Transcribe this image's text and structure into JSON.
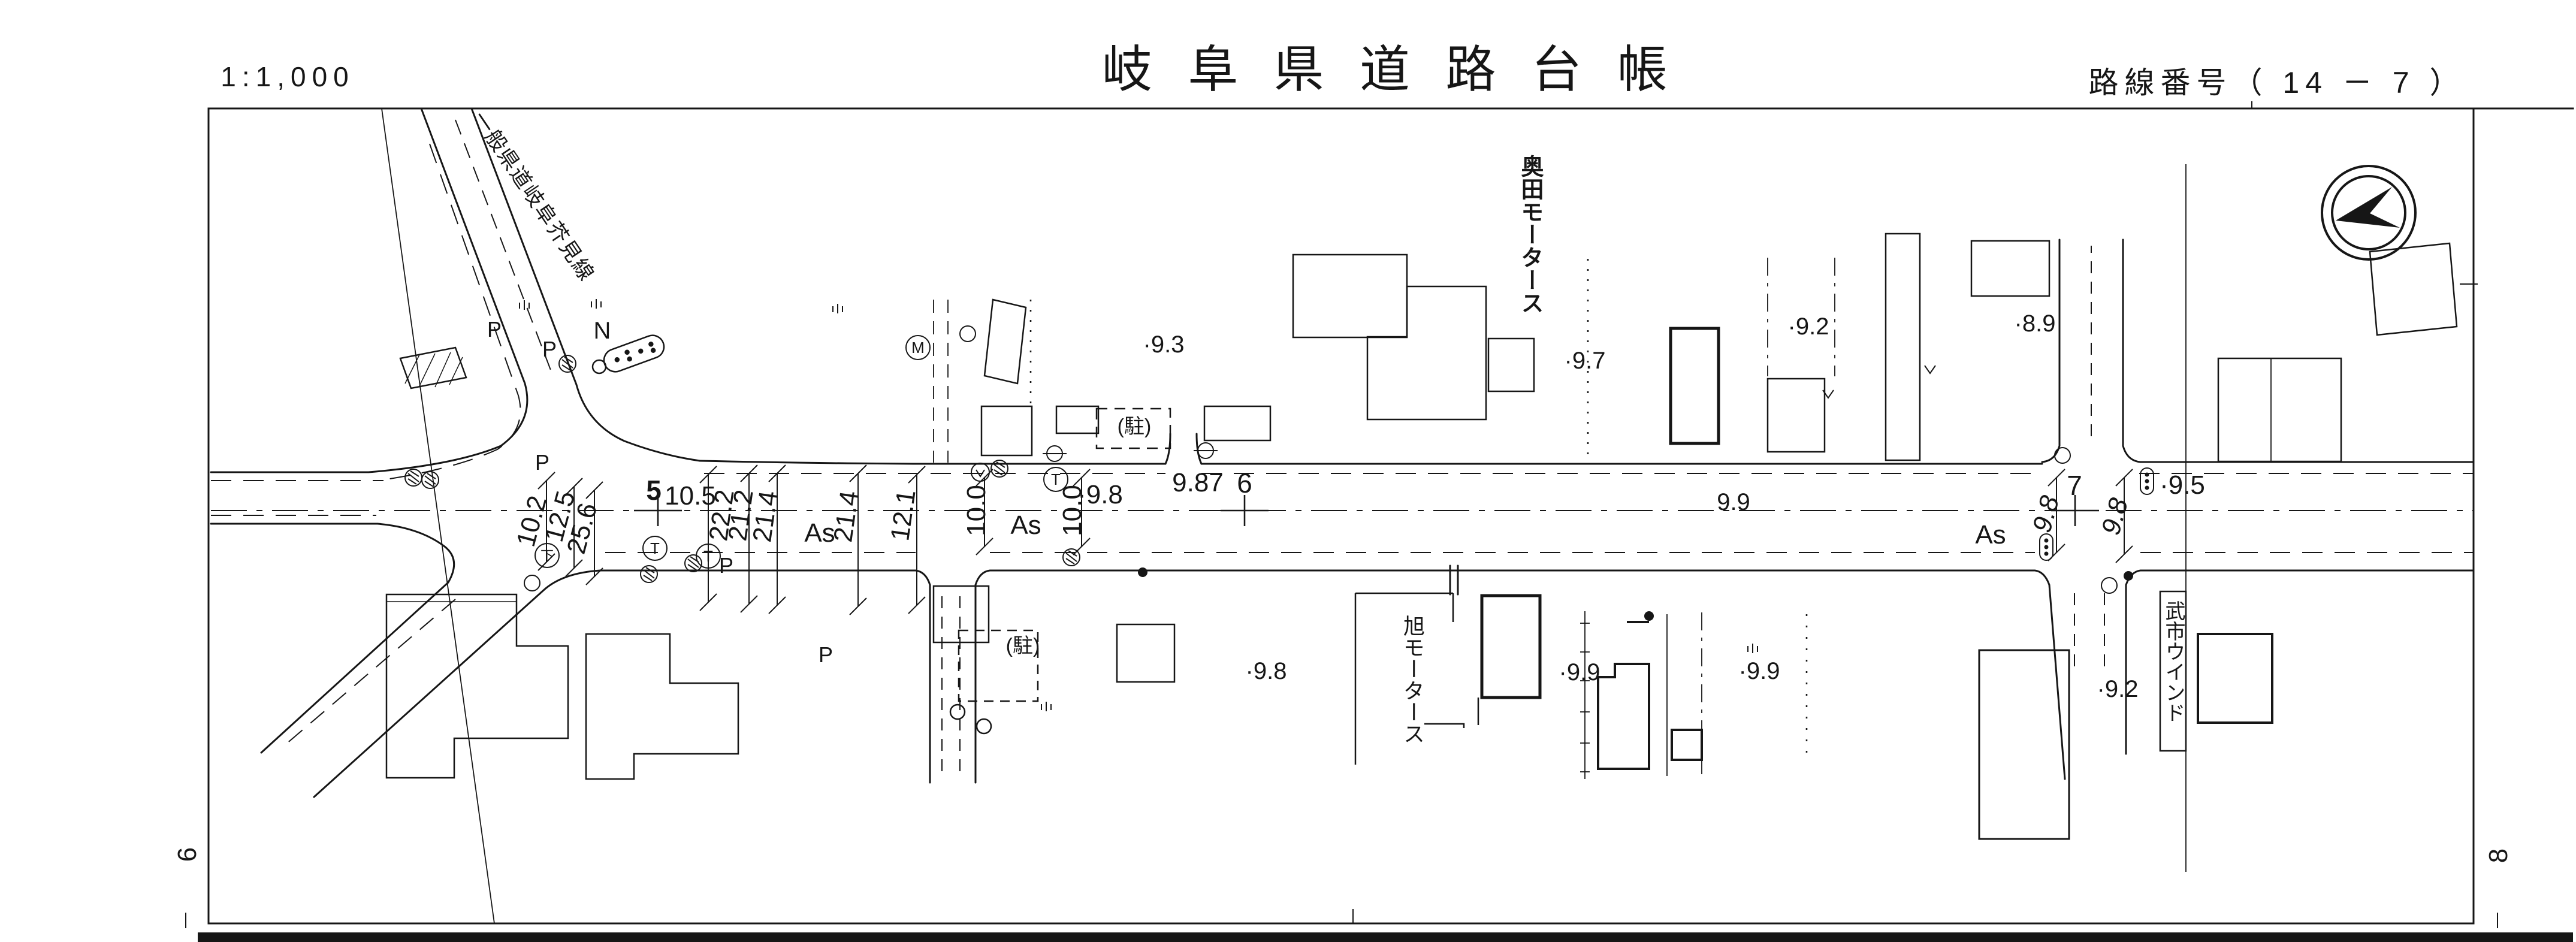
{
  "header": {
    "scale": "1:1,000",
    "title": "岐 阜 県 道 路 台 帳",
    "route_label": "路線番号（ 14 － 7 ）"
  },
  "sheet_refs": {
    "left": "6",
    "right": "8"
  },
  "map": {
    "road_name_diagonal": "一般県道岐阜芥見線",
    "businesses": {
      "okuda_motors": "奥田モータース",
      "asahi_motors": "旭モータース",
      "takechi_window": "武市ウインド"
    },
    "parking": {
      "a": "(駐)",
      "b": "(駐)"
    },
    "surface": {
      "as1": "As",
      "as2": "As",
      "as3": "As"
    },
    "stations": {
      "s5": {
        "no": "5",
        "offset": "10.5"
      },
      "s6": {
        "no": "6",
        "offset": "9.87"
      },
      "s7": {
        "no": "7"
      }
    },
    "widths": {
      "w10_2": "10.2",
      "w12_5": "12.5",
      "w25_6": "25.6",
      "w22_2": "22.2",
      "w21_2": "21.2",
      "w21_4a": "21.4",
      "w21_4b": "21.4",
      "w12_1": "12.1",
      "w10_0a": "10.0",
      "w10_0b": "10.0",
      "w9_8a": "9.8",
      "w9_8b": "9.8"
    },
    "elevations": {
      "e9_3": "·9.3",
      "e9_7": "·9.7",
      "e9_2a": "·9.2",
      "e8_9": "·8.9",
      "e9_5": "·9.5",
      "e9_8a": "·9.8",
      "e9_8b": "·9.8",
      "e9_9a": "9.9",
      "e9_9b": "·9.9",
      "e9_9c": "·9.9",
      "e9_2b": "·9.2"
    },
    "pole_labels": {
      "p1": "P",
      "p2": "P",
      "p3": "P",
      "p4": "P",
      "p5": "P",
      "n1": "N"
    },
    "symbol_glyphs": {
      "t": "T",
      "down": "下",
      "m": "M"
    }
  },
  "colors": {
    "ink": "#161616",
    "paper": "#ffffff"
  }
}
